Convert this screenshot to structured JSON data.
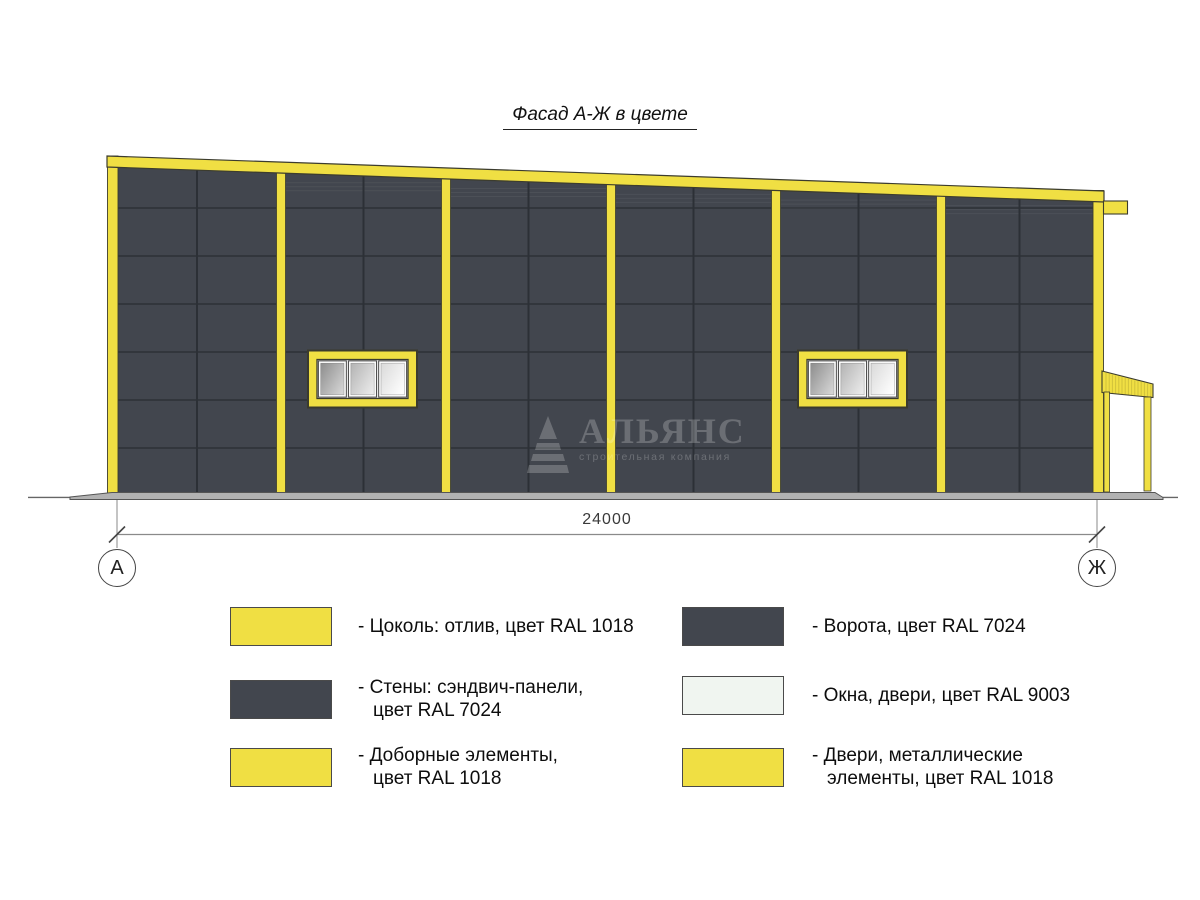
{
  "title": "Фасад А-Ж в цвете",
  "drawing": {
    "dimension_label": "24000",
    "axis_left": "А",
    "axis_right": "Ж"
  },
  "watermark": {
    "name": "АЛЬЯНС",
    "subtitle": "строительная компания",
    "logo": "pyramid-icon"
  },
  "colors": {
    "ral_1018_yellow": "#F0DF43",
    "ral_7024_grey": "#42464E",
    "ral_9003_white": "#F0F5F0",
    "panel_joint": "#2C3036",
    "outline_dark": "#3C3C2E",
    "ground_grey": "#B2B2B2",
    "dim_line_grey": "#8A8A8A",
    "watermark_grey": "rgba(255,255,255,0.22)"
  },
  "legend": {
    "items": [
      {
        "swatch": "ral_1018_yellow",
        "lines": [
          "- Цоколь: отлив, цвет RAL 1018"
        ]
      },
      {
        "swatch": "ral_7024_grey",
        "lines": [
          "- Стены: сэндвич-панели,",
          "цвет RAL 7024"
        ]
      },
      {
        "swatch": "ral_1018_yellow",
        "lines": [
          "- Доборные элементы,",
          "цвет RAL 1018"
        ]
      },
      {
        "swatch": "ral_7024_grey",
        "lines": [
          "- Ворота, цвет RAL 7024"
        ]
      },
      {
        "swatch": "ral_9003_white",
        "lines": [
          "- Окна, двери, цвет RAL 9003"
        ]
      },
      {
        "swatch": "ral_1018_yellow",
        "lines": [
          "- Двери, металлические",
          "элементы, цвет RAL 1018"
        ]
      }
    ]
  }
}
